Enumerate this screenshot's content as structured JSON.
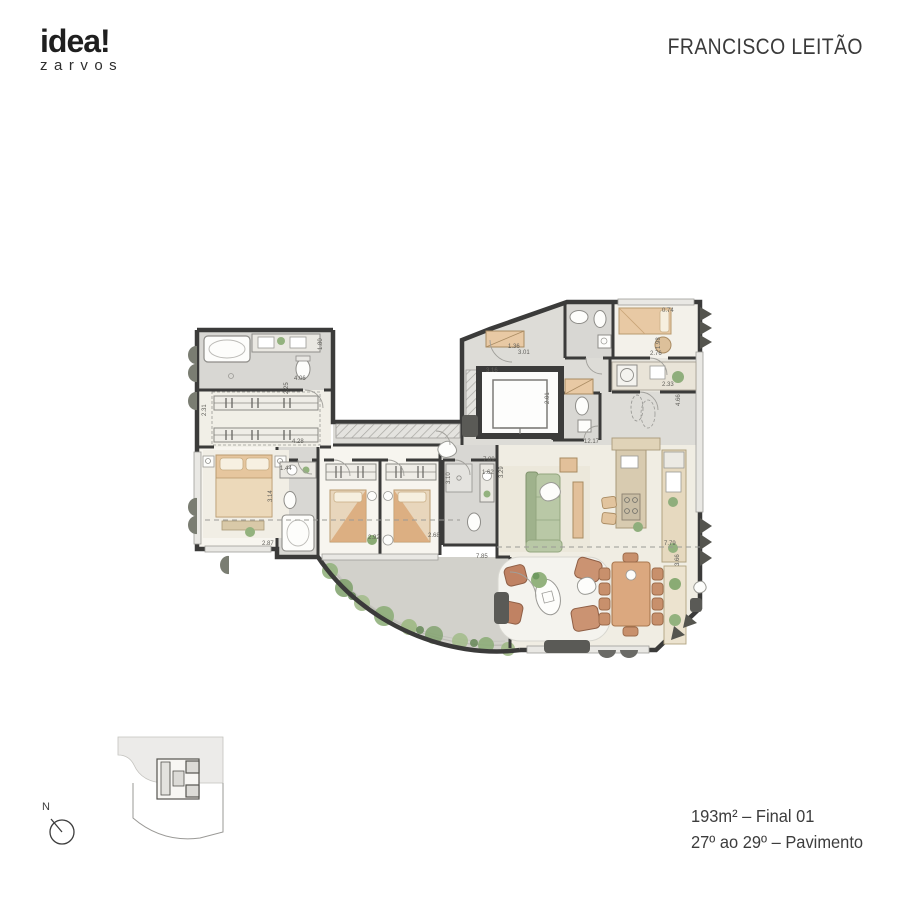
{
  "brand": {
    "name": "idea!",
    "sub": "zarvos"
  },
  "header": {
    "project_title": "FRANCISCO LEITÃO"
  },
  "footer": {
    "area_line": "193m² – Final 01",
    "floor_line": "27º ao 29º – Pavimento"
  },
  "compass": {
    "label": "N"
  },
  "plan": {
    "dims": {
      "d1": "2.31",
      "d2": "2.25",
      "d3": "4.06",
      "d4": "1.80",
      "d5": "4.28",
      "d6": "1.44",
      "d7": "3.14",
      "d8": "2.87",
      "d9": "2.92",
      "d10": "2.68",
      "d11": "3.10",
      "d12": "1.62",
      "d13": "7.89",
      "d14": "3.29",
      "d15": "7.85",
      "d16": "7.79",
      "d17": "3.66",
      "d18": "12.17",
      "d19": "2.01",
      "d20": "3.01",
      "d21": "1.36",
      "d22": "3.16",
      "d23": "2.76",
      "d24": "0.74",
      "d25": "1.98",
      "d26": "2.33",
      "d27": "4.66"
    }
  }
}
